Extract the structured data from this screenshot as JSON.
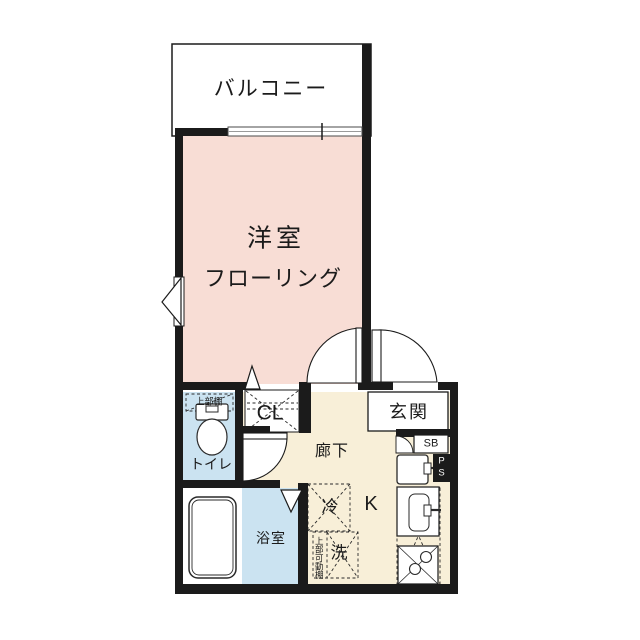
{
  "floorplan": {
    "balcony": {
      "label": "バルコニー"
    },
    "main_room": {
      "label": "洋室",
      "sublabel": "フローリング"
    },
    "entrance": {
      "label": "玄関"
    },
    "hallway": {
      "label": "廊下"
    },
    "toilet": {
      "label": "トイレ",
      "shelf_label": "上部棚"
    },
    "closet": {
      "label": "CL"
    },
    "bathroom": {
      "label": "浴室"
    },
    "kitchen": {
      "label": "K"
    },
    "refrigerator": {
      "label": "冷"
    },
    "washer": {
      "label": "洗",
      "shelf_label": "上部可動棚"
    },
    "shoe_box": {
      "label": "SB"
    },
    "pipe_space": {
      "line1": "P",
      "line2": "S"
    },
    "colors": {
      "room_pink": "#f8ddd5",
      "wet_blue": "#cbe3f1",
      "hall_cream": "#f8efd8",
      "wall": "#1b1b1b"
    }
  }
}
